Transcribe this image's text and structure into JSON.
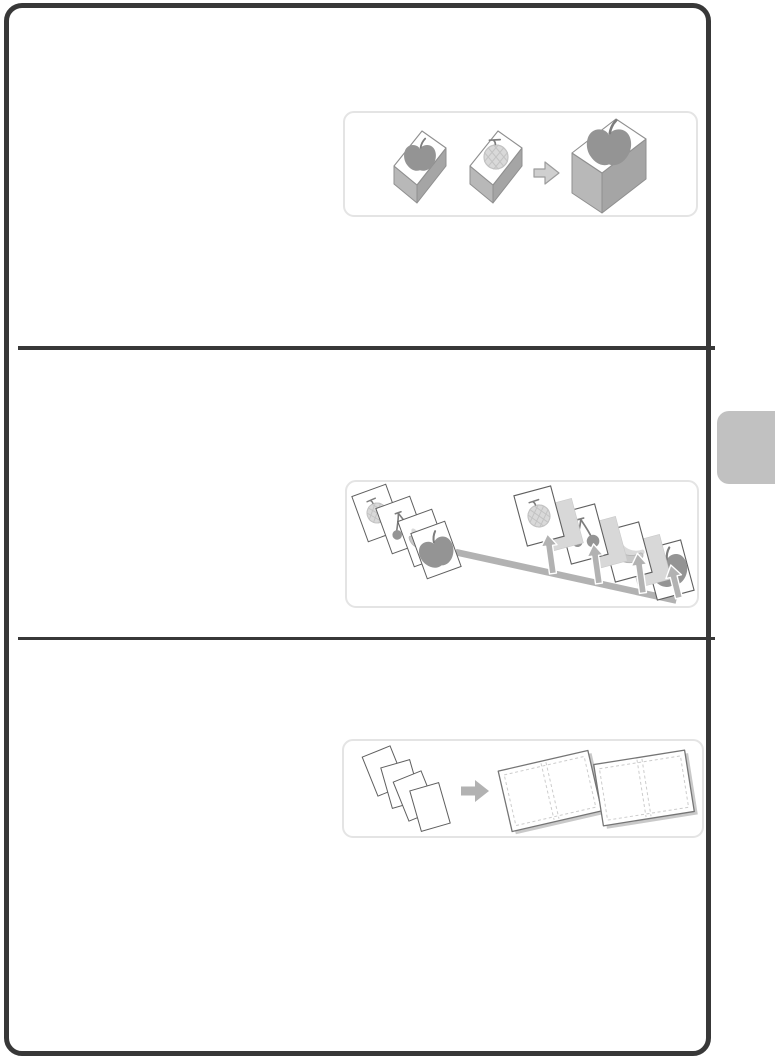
{
  "colors": {
    "page_border": "#383838",
    "divider": "#383838",
    "panel_fill": "#ffffff",
    "panel_border": "#e4e4e4",
    "tab_fill": "#c1c1c1",
    "box_side_light": "#b8b8b8",
    "box_side_dark": "#a5a5a5",
    "box_outline": "#8f8f8f",
    "sheet_stroke": "#5f5f5f",
    "separator_fill": "#d8d8d8",
    "separator_stroke": "#c9c9c9",
    "fruit_dark": "#949494",
    "fruit_mid": "#c9c9c9",
    "fruit_light": "#d9d9d9",
    "fruit_lattice": "#c3c3c3",
    "stem": "#7d7d7d",
    "arrow_light_fill": "#cfcfcf",
    "arrow_light_stroke": "#9c9c9c",
    "arrow_gray": "#b2b2b2",
    "dash": "#cccccc",
    "spread_stroke": "#757575",
    "spread_shadow": "#c9c9c9"
  },
  "sections": [
    {
      "name": "combine-originals",
      "panel_icons": [
        "apple-box-icon",
        "melon-box-icon",
        "merge-arrow-icon",
        "large-apple-box-icon"
      ]
    },
    {
      "name": "separator-pages",
      "panel_icons": [
        "fruit-sheet-stack-icon",
        "distribution-bar-arrow-icon",
        "melon-sheet-icon",
        "separator-sheet-icon",
        "cherry-sheet-icon",
        "banana-sheet-icon",
        "apple-sheet-icon",
        "up-arrow-icon"
      ]
    },
    {
      "name": "booklet-spreads",
      "panel_icons": [
        "loose-sheet-stack-icon",
        "right-arrow-icon",
        "open-spread-icon",
        "open-spread-icon"
      ]
    }
  ],
  "side_tab": {
    "icon": "chapter-index-tab"
  }
}
